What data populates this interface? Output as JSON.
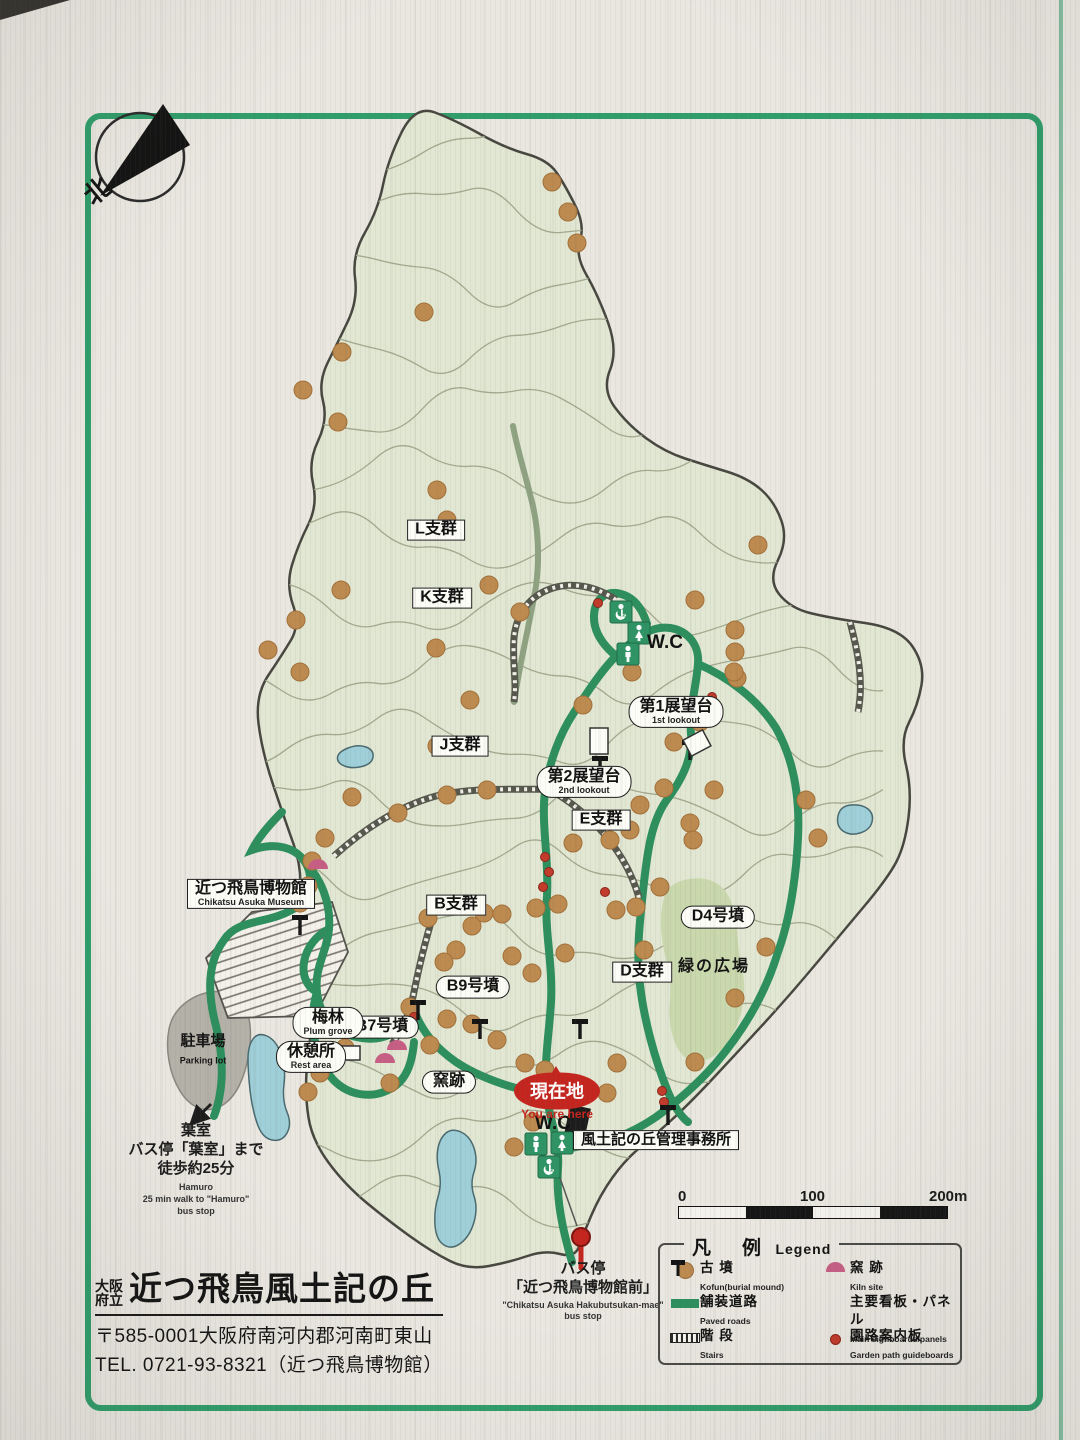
{
  "sign": {
    "title_prefix_line1": "大阪",
    "title_prefix_line2": "府立",
    "title": "近つ飛鳥風土記の丘",
    "address": "〒585-0001大阪府南河内郡河南町東山",
    "tel": "TEL. 0721-93-8321（近つ飛鳥博物館）"
  },
  "compass": {
    "north": "北"
  },
  "map_labels": {
    "l_group": "L支群",
    "k_group": "K支群",
    "j_group": "J支群",
    "b_group": "B支群",
    "e_group": "E支群",
    "d_group": "D支群",
    "b9": "B9号墳",
    "b7": "B7号墳",
    "d4": "D4号墳",
    "lookout1_jp": "第1展望台",
    "lookout1_en": "1st lookout",
    "lookout2_jp": "第2展望台",
    "lookout2_en": "2nd lookout",
    "wc": "W.C",
    "museum_jp": "近つ飛鳥博物館",
    "museum_en": "Chikatsu Asuka Museum",
    "parking_jp": "駐車場",
    "parking_en": "Parking lot",
    "plum_jp": "梅林",
    "plum_en": "Plum grove",
    "rest_jp": "休憩所",
    "rest_en": "Rest area",
    "kiln": "窯跡",
    "green_plaza": "緑の広場",
    "here_jp": "現在地",
    "here_en": "You are here",
    "office": "風土記の丘管理事務所"
  },
  "hamuro": {
    "jp1": "葉室",
    "jp2": "バス停「葉室」まで",
    "jp3": "徒歩約25分",
    "en1": "Hamuro",
    "en2": "25 min walk to \"Hamuro\"",
    "en3": "bus stop"
  },
  "bus_stop": {
    "jp1": "バス停",
    "jp2": "「近つ飛鳥博物館前」",
    "en1": "\"Chikatsu Asuka Hakubutsukan-mae\"",
    "en2": "bus stop"
  },
  "scale_bar": {
    "t0": "0",
    "t100": "100",
    "t200": "200m"
  },
  "legend": {
    "title_jp": "凡　例",
    "title_en": "Legend",
    "items": [
      {
        "jp": "古 墳",
        "en": "Kofun(burial mound)",
        "icon": "kofun-dot"
      },
      {
        "jp": "窯 跡",
        "en": "Kiln site",
        "icon": "kiln-dome"
      },
      {
        "jp": "舗装道路",
        "en": "Paved roads",
        "icon": "paved-road"
      },
      {
        "jp": "主要看板・パネル",
        "en": "Main signboards/panels",
        "icon": "signboard"
      },
      {
        "jp": "階 段",
        "en": "Stairs",
        "icon": "stairs"
      },
      {
        "jp": "園路案内板",
        "en": "Garden path guideboards",
        "icon": "guideboard"
      }
    ]
  },
  "colors": {
    "frame_green": "#2f9e6b",
    "road_green": "#2e8f5e",
    "park_fill": "#e1e7d2",
    "kofun": "#bd8a50",
    "guideboard_red": "#c23b2b",
    "kiln_pink": "#c75f85",
    "pond_blue": "#9fcfd8",
    "here_red": "#c4261f"
  }
}
